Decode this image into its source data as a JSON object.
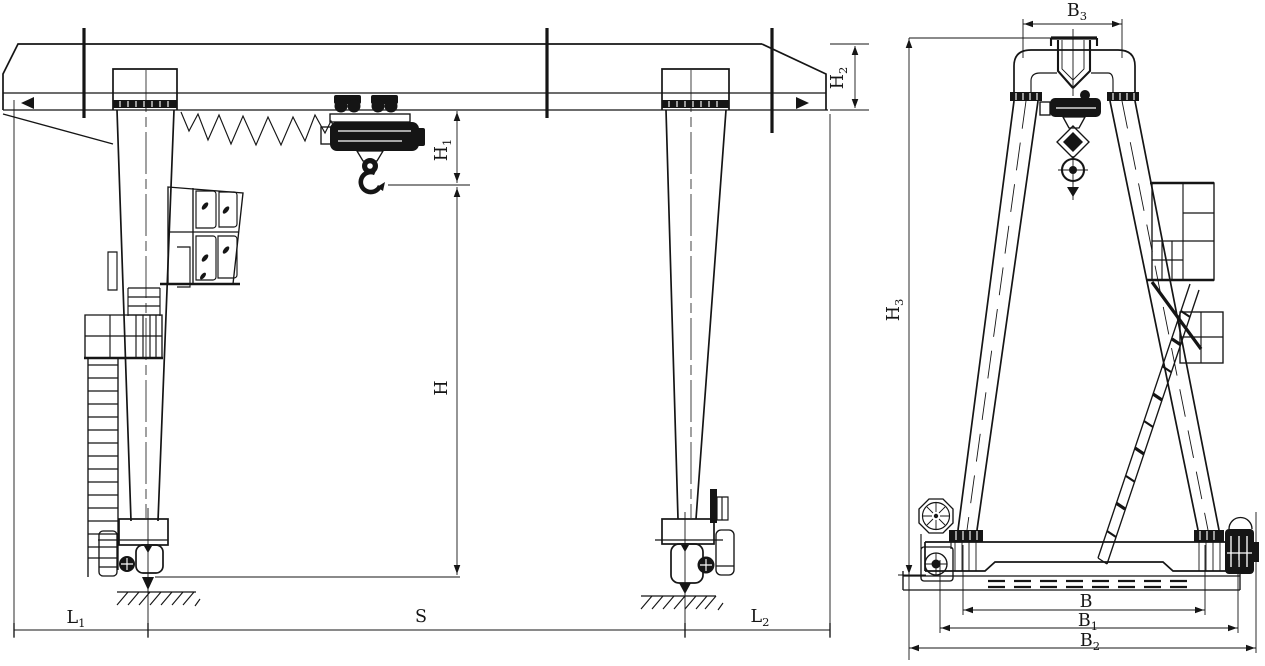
{
  "drawing": {
    "views": {
      "left": "front-elevation",
      "right": "side-end-elevation"
    },
    "colors": {
      "ink": "#151515",
      "paper": "#ffffff"
    }
  },
  "labels": {
    "h1": {
      "base": "H",
      "sub": "1"
    },
    "h2": {
      "base": "H",
      "sub": "2"
    },
    "h": {
      "base": "H",
      "sub": ""
    },
    "s": {
      "base": "S",
      "sub": ""
    },
    "l1": {
      "base": "L",
      "sub": "1"
    },
    "l2": {
      "base": "L",
      "sub": "2"
    },
    "b3": {
      "base": "B",
      "sub": "3"
    },
    "h3": {
      "base": "H",
      "sub": "3"
    },
    "b": {
      "base": "B",
      "sub": ""
    },
    "b1": {
      "base": "B",
      "sub": "1"
    },
    "b2": {
      "base": "B",
      "sub": "2"
    }
  }
}
